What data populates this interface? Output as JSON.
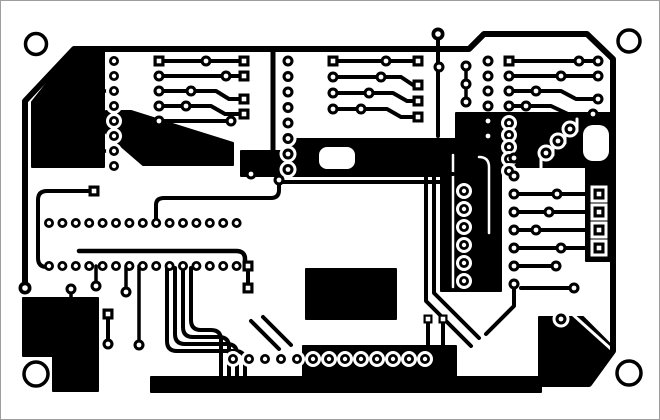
{
  "figure": {
    "kind": "pcb-copper-track-layout",
    "orientation": "landscape"
  },
  "canvas": {
    "width": 660,
    "height": 420,
    "background": "#ffffff",
    "frame_color": "#9e9e9e",
    "copper_color": "#000000",
    "clearance_color": "#ffffff"
  },
  "board": {
    "outline": {
      "d": "M24 287 V100 L73 48 H468 L483 33 H586 L612 58 V350 L588 383 H152",
      "w": 6
    },
    "holes": [
      {
        "x": 35,
        "y": 43,
        "r": 10.5
      },
      {
        "x": 628,
        "y": 40,
        "r": 11
      },
      {
        "x": 35,
        "y": 373,
        "r": 12
      },
      {
        "x": 628,
        "y": 372,
        "r": 12
      }
    ],
    "fills": [
      "M73 48 H103 V166 H31 V101 Z",
      "M105 110 L130 110 L232 142 L232 164 L142 164 L105 132 Z",
      "M240 150 H300 V175 H240 Z",
      "M290 138 H455 V175 H290 Z",
      "M455 112 H610 V166 H455 Z",
      "M440 148 H500 V290 H440 Z",
      "M305 268 H395 V318 H305 Z",
      "M150 376 H540 V391 H150 Z",
      "M302 345 H455 V378 H302 Z",
      "M22 297 H97 V390 H52 V355 H22 Z",
      "M538 316 H582 L612 346 V352 L586 380 H538 Z",
      "M585 150 H612 V260 H585 Z"
    ],
    "white_cutouts": [
      {
        "x": 318,
        "y": 146,
        "w": 36,
        "h": 22,
        "r": 8
      },
      {
        "x": 582,
        "y": 124,
        "w": 26,
        "h": 36,
        "r": 10
      }
    ],
    "white_traces": [
      {
        "d": "M540 168 V154 H552 V142 H564 V130 H576 V118",
        "w": 3
      },
      {
        "d": "M452 154 V286",
        "w": 2.5
      },
      {
        "d": "M478 156 Q488 156 488 166 V232",
        "w": 2.5
      },
      {
        "d": "M570 312 L610 348",
        "w": 3
      }
    ],
    "traces": [
      {
        "d": "M272 48 V158",
        "w": 5
      },
      {
        "d": "M437 35 V135",
        "w": 4
      },
      {
        "d": "M158 60 H243",
        "w": 4
      },
      {
        "d": "M158 75 H243",
        "w": 4
      },
      {
        "d": "M158 90 H215 L228 98 H243",
        "w": 4
      },
      {
        "d": "M158 105 H210 L224 113 H243",
        "w": 4
      },
      {
        "d": "M158 120 H230",
        "w": 4
      },
      {
        "d": "M101 90 H113",
        "w": 3.5
      },
      {
        "d": "M101 150 H113",
        "w": 3.5
      },
      {
        "d": "M332 60 H417",
        "w": 4
      },
      {
        "d": "M332 76 H400 L412 84 H417",
        "w": 4
      },
      {
        "d": "M332 92 H392 L406 100 H417",
        "w": 4
      },
      {
        "d": "M332 108 H386 L400 116 H417",
        "w": 4
      },
      {
        "d": "M465 65 V101",
        "w": 3.5
      },
      {
        "d": "M508 60 H597",
        "w": 4
      },
      {
        "d": "M508 75 H597",
        "w": 4
      },
      {
        "d": "M508 90 H560 L575 98 H597",
        "w": 4
      },
      {
        "d": "M508 105 H550 L567 113 H592",
        "w": 4
      },
      {
        "d": "M513 193 H598",
        "w": 4
      },
      {
        "d": "M513 211 H598",
        "w": 4
      },
      {
        "d": "M513 229 H598",
        "w": 4
      },
      {
        "d": "M513 247 H598",
        "w": 4
      },
      {
        "d": "M513 265 H555",
        "w": 4
      },
      {
        "d": "M250 173 H452",
        "w": 4
      },
      {
        "d": "M278 181 H447",
        "w": 4
      },
      {
        "d": "M155 224 V204 Q155 197 163 197 H270 Q278 197 278 189 V181",
        "w": 4
      },
      {
        "d": "M88 190 H46 Q37 190 37 199 V257 Q37 266 46 266 H50",
        "w": 4
      },
      {
        "d": "M78 250 H235 Q244 250 244 258 V262",
        "w": 4.5
      },
      {
        "d": "M125 265 V288",
        "w": 3.5
      },
      {
        "d": "M95 265 V282",
        "w": 3.5
      },
      {
        "d": "M138 265 V341",
        "w": 3.5
      },
      {
        "d": "M247 265 V287",
        "w": 4
      },
      {
        "d": "M166 267 V340 Q166 350 176 350 H234 Q244 350 244 360 V383",
        "w": 4
      },
      {
        "d": "M174 267 V333 Q174 343 184 343 H226 Q236 343 236 353 V383",
        "w": 4
      },
      {
        "d": "M182 267 V326 Q182 336 192 336 H218 Q228 336 228 346 V383",
        "w": 4
      },
      {
        "d": "M190 267 V319 Q190 329 200 329 H210 Q220 329 220 339 V383",
        "w": 4
      },
      {
        "d": "M250 320 L278 348",
        "w": 4
      },
      {
        "d": "M262 316 L290 344",
        "w": 4
      },
      {
        "d": "M425 175 V300 L470 345",
        "w": 4
      },
      {
        "d": "M433 175 V292 L478 337",
        "w": 4
      },
      {
        "d": "M513 283 V305 L485 333",
        "w": 4
      },
      {
        "d": "M520 287 H573",
        "w": 4
      },
      {
        "d": "M70 288 V297",
        "w": 3.5
      },
      {
        "d": "M107 313 V340",
        "w": 4
      },
      {
        "d": "M427 318 V345",
        "w": 4
      },
      {
        "d": "M442 318 V345",
        "w": 4
      }
    ],
    "pad_rows": [
      {
        "x0": 113,
        "y0": 60,
        "dx": 0,
        "dy": 15,
        "n": 8,
        "r": 5,
        "hole": 2.2,
        "clr": true
      },
      {
        "x0": 158,
        "y0": 75,
        "dx": 0,
        "dy": 15,
        "n": 4,
        "r": 5.5,
        "hole": 2.4,
        "clr": false
      },
      {
        "x0": 287,
        "y0": 60,
        "dx": 0,
        "dy": 15.5,
        "n": 8,
        "r": 5.5,
        "hole": 2.4,
        "clr": true
      },
      {
        "x0": 332,
        "y0": 76,
        "dx": 0,
        "dy": 16,
        "n": 3,
        "r": 5.5,
        "hole": 2.4,
        "clr": false
      },
      {
        "x0": 487,
        "y0": 60,
        "dx": 0,
        "dy": 15,
        "n": 6,
        "r": 5.5,
        "hole": 2.4,
        "clr": false
      },
      {
        "x0": 465,
        "y0": 65,
        "dx": 0,
        "dy": 18,
        "n": 3,
        "r": 5.5,
        "hole": 2.4,
        "clr": false
      },
      {
        "x0": 508,
        "y0": 75,
        "dx": 0,
        "dy": 15,
        "n": 3,
        "r": 5.5,
        "hole": 2.4,
        "clr": false
      },
      {
        "x0": 508,
        "y0": 122,
        "dx": 0,
        "dy": 12,
        "n": 5,
        "r": 5,
        "hole": 2.2,
        "clr": true
      },
      {
        "x0": 513,
        "y0": 157,
        "dx": 0,
        "dy": 18,
        "n": 8,
        "r": 5.5,
        "hole": 2.4,
        "clr": false
      },
      {
        "x0": 463,
        "y0": 190,
        "dx": 0,
        "dy": 18,
        "n": 6,
        "r": 5,
        "hole": 2.2,
        "clr": true
      },
      {
        "x0": 48,
        "y0": 222,
        "dx": 13.4,
        "dy": 0,
        "n": 15,
        "r": 5,
        "hole": 2.2,
        "clr": false
      },
      {
        "x0": 48,
        "y0": 265,
        "dx": 13.4,
        "dy": 0,
        "n": 15,
        "r": 5,
        "hole": 2.2,
        "clr": false
      },
      {
        "x0": 232,
        "y0": 358,
        "dx": 16,
        "dy": 0,
        "n": 13,
        "r": 5,
        "hole": 2.2,
        "clr": true
      }
    ],
    "pads": [
      {
        "x": 158,
        "y": 60,
        "shape": "square"
      },
      {
        "x": 243,
        "y": 60,
        "shape": "square"
      },
      {
        "x": 243,
        "y": 75,
        "shape": "square"
      },
      {
        "x": 243,
        "y": 98,
        "shape": "square"
      },
      {
        "x": 243,
        "y": 113,
        "shape": "square"
      },
      {
        "x": 205,
        "y": 60
      },
      {
        "x": 225,
        "y": 75
      },
      {
        "x": 190,
        "y": 90
      },
      {
        "x": 185,
        "y": 105
      },
      {
        "x": 230,
        "y": 120
      },
      {
        "x": 332,
        "y": 60,
        "shape": "square"
      },
      {
        "x": 417,
        "y": 60,
        "shape": "square"
      },
      {
        "x": 417,
        "y": 84,
        "shape": "square"
      },
      {
        "x": 417,
        "y": 100,
        "shape": "square"
      },
      {
        "x": 417,
        "y": 116,
        "shape": "square"
      },
      {
        "x": 385,
        "y": 60
      },
      {
        "x": 380,
        "y": 76
      },
      {
        "x": 368,
        "y": 92
      },
      {
        "x": 360,
        "y": 108
      },
      {
        "x": 438,
        "y": 66
      },
      {
        "x": 508,
        "y": 60,
        "shape": "square"
      },
      {
        "x": 578,
        "y": 60
      },
      {
        "x": 597,
        "y": 60
      },
      {
        "x": 560,
        "y": 75
      },
      {
        "x": 597,
        "y": 75
      },
      {
        "x": 535,
        "y": 90
      },
      {
        "x": 597,
        "y": 98
      },
      {
        "x": 525,
        "y": 105
      },
      {
        "x": 592,
        "y": 113
      },
      {
        "x": 545,
        "y": 152,
        "clr": true
      },
      {
        "x": 557,
        "y": 140,
        "clr": true
      },
      {
        "x": 569,
        "y": 128,
        "clr": true
      },
      {
        "x": 598,
        "y": 193,
        "shape": "square",
        "clr": true
      },
      {
        "x": 598,
        "y": 211,
        "shape": "square",
        "clr": true
      },
      {
        "x": 598,
        "y": 229,
        "shape": "square",
        "clr": true
      },
      {
        "x": 598,
        "y": 247,
        "shape": "square",
        "clr": true
      },
      {
        "x": 556,
        "y": 193
      },
      {
        "x": 548,
        "y": 211
      },
      {
        "x": 535,
        "y": 229
      },
      {
        "x": 560,
        "y": 247
      },
      {
        "x": 555,
        "y": 265
      },
      {
        "x": 250,
        "y": 173
      },
      {
        "x": 278,
        "y": 179
      },
      {
        "x": 93,
        "y": 190,
        "shape": "square"
      },
      {
        "x": 125,
        "y": 291
      },
      {
        "x": 95,
        "y": 285
      },
      {
        "x": 138,
        "y": 344
      },
      {
        "x": 247,
        "y": 265,
        "shape": "square"
      },
      {
        "x": 247,
        "y": 287,
        "shape": "square"
      },
      {
        "x": 70,
        "y": 288
      },
      {
        "x": 107,
        "y": 313,
        "shape": "square"
      },
      {
        "x": 107,
        "y": 343
      },
      {
        "x": 427,
        "y": 318,
        "shape": "square",
        "s": 9
      },
      {
        "x": 442,
        "y": 318,
        "shape": "square",
        "s": 9
      },
      {
        "x": 573,
        "y": 287
      },
      {
        "x": 560,
        "y": 318,
        "clr": true
      },
      {
        "x": 24,
        "y": 287,
        "r": 6.5,
        "hole": 2.8
      },
      {
        "x": 437,
        "y": 33,
        "r": 6.5,
        "hole": 2.8
      }
    ],
    "white_dots": [
      {
        "x": 160,
        "y": 155
      },
      {
        "x": 173,
        "y": 155
      },
      {
        "x": 186,
        "y": 156
      },
      {
        "x": 199,
        "y": 156
      },
      {
        "x": 325,
        "y": 283
      },
      {
        "x": 350,
        "y": 283
      },
      {
        "x": 375,
        "y": 283
      },
      {
        "x": 337,
        "y": 304
      },
      {
        "x": 362,
        "y": 304
      }
    ]
  }
}
